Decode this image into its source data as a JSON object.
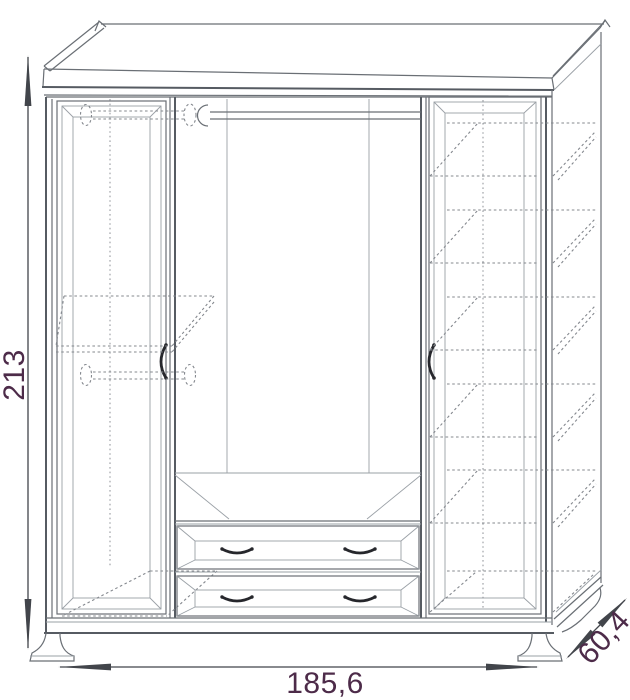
{
  "drawing": {
    "title": "wardrobe technical line drawing",
    "view": "frontal schematic with depth shown on right side",
    "dimensions": {
      "height": "213",
      "width": "185,6",
      "depth": "60,4"
    },
    "structure": {
      "sections": [
        {
          "name": "left",
          "features": [
            "hinged door",
            "hidden upper hanging rod",
            "hidden shelf",
            "hidden lower hanging rod"
          ]
        },
        {
          "name": "middle",
          "features": [
            "open hanging space",
            "hanging rod",
            "two drawers"
          ]
        },
        {
          "name": "right",
          "features": [
            "hinged door",
            "five hidden shelves"
          ]
        }
      ],
      "drawer_count": 2,
      "shelf_count_right": 5,
      "hanging_rod_count": 3,
      "handle_count": 6
    },
    "colors": {
      "background": "#ffffff",
      "line_main": "#6a6f75",
      "line_heavy": "#565b62",
      "line_light": "#9aa0a6",
      "line_hidden": "#84888e",
      "handle": "#26272c",
      "dimension_line": "#42454b",
      "dimension_text": "#4d2b49"
    }
  }
}
